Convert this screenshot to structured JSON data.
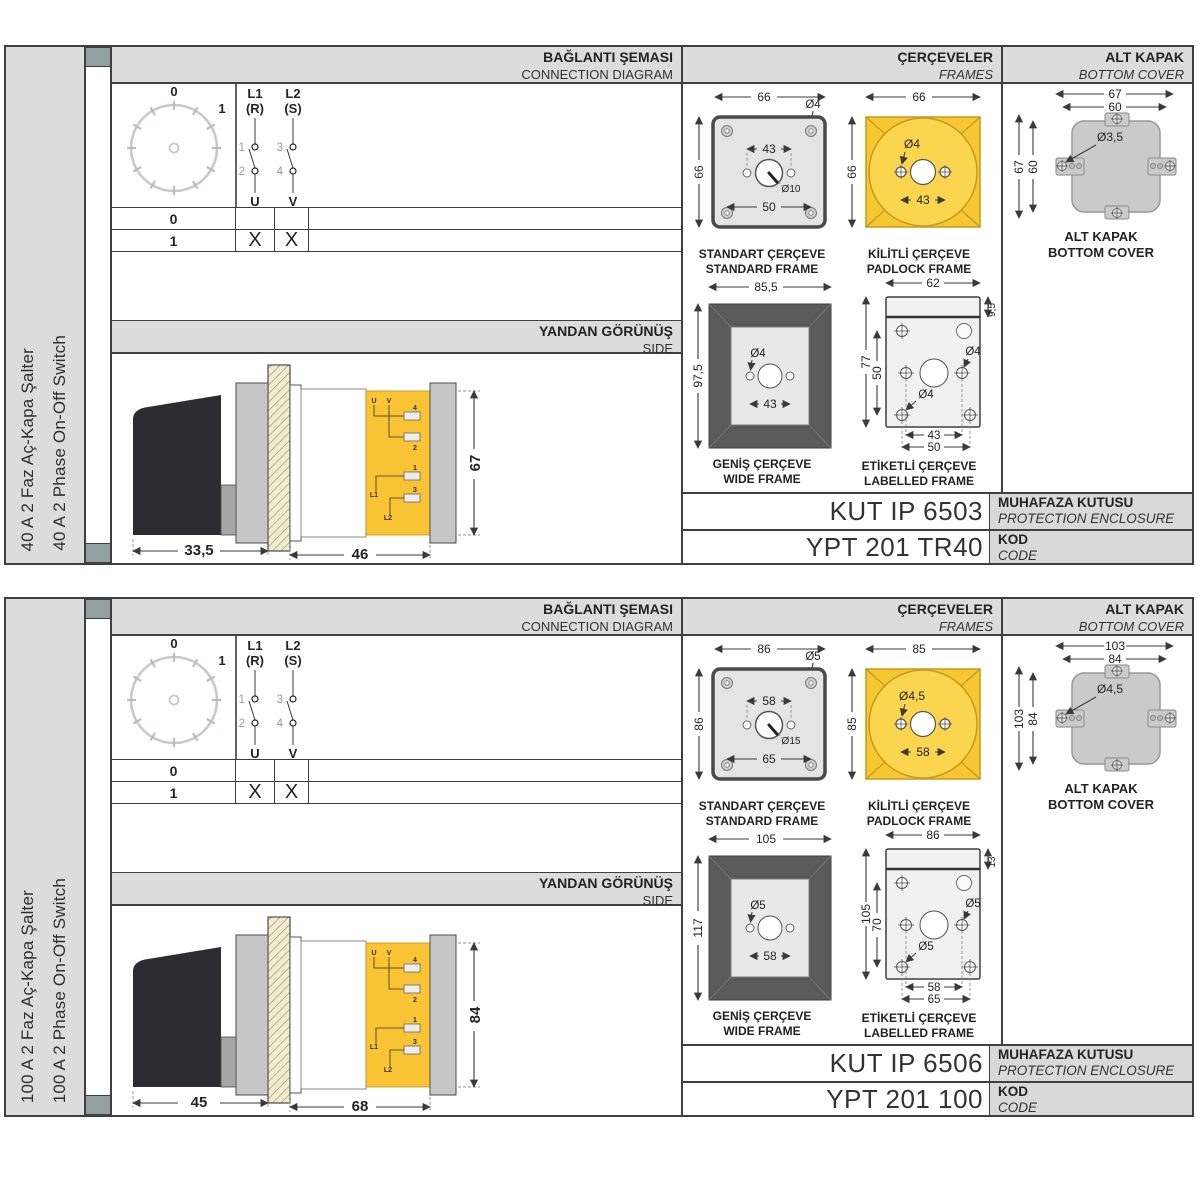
{
  "panels": [
    {
      "side_label_tr": "40 A 2 Faz Aç-Kapa Şalter",
      "side_label_en": "40 A 2 Phase On-Off Switch",
      "headers": {
        "connection_tr": "BAĞLANTI ŞEMASI",
        "connection_en": "CONNECTION DIAGRAM",
        "frames_tr": "ÇERÇEVELER",
        "frames_en": "FRAMES",
        "cover_tr": "ALT KAPAK",
        "cover_en": "BOTTOM COVER",
        "side_tr": "YANDAN GÖRÜNÜŞ",
        "side_en": "SIDE"
      },
      "connection": {
        "dial": {
          "pos0": "0",
          "pos1": "1"
        },
        "contacts": {
          "l1": "L1",
          "l1_phase": "(R)",
          "l2": "L2",
          "l2_phase": "(S)",
          "t1": "1",
          "t2": "2",
          "t3": "3",
          "t4": "4",
          "u": "U",
          "v": "V"
        },
        "table": {
          "rows": [
            {
              "pos": "0",
              "u": "",
              "v": ""
            },
            {
              "pos": "1",
              "u": "X",
              "v": "X"
            }
          ]
        }
      },
      "side_view": {
        "dim_front": "33,5",
        "dim_body": "46",
        "dim_height": "67",
        "terminals": {
          "u": "U",
          "v": "V",
          "n4": "4",
          "n2": "2",
          "n1": "1",
          "n3": "3",
          "l1": "L1",
          "l2": "L2"
        }
      },
      "frames": {
        "standard": {
          "caption_tr": "STANDART ÇERÇEVE",
          "caption_en": "STANDARD FRAME",
          "width": "66",
          "height": "66",
          "hole_dia": "Ø4",
          "top_span": "43",
          "bottom_span": "50",
          "center_dia": "Ø10"
        },
        "padlock": {
          "caption_tr": "KİLİTLİ ÇERÇEVE",
          "caption_en": "PADLOCK FRAME",
          "width": "66",
          "height": "66",
          "hole_dia": "Ø4",
          "span": "43"
        },
        "wide": {
          "caption_tr": "GENİŞ ÇERÇEVE",
          "caption_en": "WIDE FRAME",
          "width": "85,5",
          "height": "97,5",
          "hole_dia": "Ø4",
          "span": "43"
        },
        "labelled": {
          "caption_tr": "ETİKETLİ ÇERÇEVE",
          "caption_en": "LABELLED FRAME",
          "top_width": "62",
          "strip": "9,5",
          "height": "77",
          "inner_height": "50",
          "hole_dia": "Ø4",
          "hole_dia2": "Ø4",
          "span1": "43",
          "span2": "50"
        }
      },
      "bottom_cover": {
        "caption_tr": "ALT KAPAK",
        "caption_en": "BOTTOM COVER",
        "outer_w": "67",
        "inner_w": "60",
        "outer_h": "67",
        "inner_h": "60",
        "hole_dia": "Ø3,5"
      },
      "codes": {
        "enclosure_value": "KUT IP 6503",
        "enclosure_label_tr": "MUHAFAZA KUTUSU",
        "enclosure_label_en": "PROTECTION ENCLOSURE",
        "code_value": "YPT 201 TR40",
        "code_label_tr": "KOD",
        "code_label_en": "CODE"
      }
    },
    {
      "side_label_tr": "100 A 2 Faz Aç-Kapa Şalter",
      "side_label_en": "100 A 2 Phase On-Off Switch",
      "headers": {
        "connection_tr": "BAĞLANTI ŞEMASI",
        "connection_en": "CONNECTION DIAGRAM",
        "frames_tr": "ÇERÇEVELER",
        "frames_en": "FRAMES",
        "cover_tr": "ALT KAPAK",
        "cover_en": "BOTTOM COVER",
        "side_tr": "YANDAN GÖRÜNÜŞ",
        "side_en": "SIDE"
      },
      "connection": {
        "dial": {
          "pos0": "0",
          "pos1": "1"
        },
        "contacts": {
          "l1": "L1",
          "l1_phase": "(R)",
          "l2": "L2",
          "l2_phase": "(S)",
          "t1": "1",
          "t2": "2",
          "t3": "3",
          "t4": "4",
          "u": "U",
          "v": "V"
        },
        "table": {
          "rows": [
            {
              "pos": "0",
              "u": "",
              "v": ""
            },
            {
              "pos": "1",
              "u": "X",
              "v": "X"
            }
          ]
        }
      },
      "side_view": {
        "dim_front": "45",
        "dim_body": "68",
        "dim_height": "84",
        "terminals": {
          "u": "U",
          "v": "V",
          "n4": "4",
          "n2": "2",
          "n1": "1",
          "n3": "3",
          "l1": "L1",
          "l2": "L2"
        }
      },
      "frames": {
        "standard": {
          "caption_tr": "STANDART ÇERÇEVE",
          "caption_en": "STANDARD FRAME",
          "width": "86",
          "height": "86",
          "hole_dia": "Ø5",
          "top_span": "58",
          "bottom_span": "65",
          "center_dia": "Ø15"
        },
        "padlock": {
          "caption_tr": "KİLİTLİ ÇERÇEVE",
          "caption_en": "PADLOCK FRAME",
          "width": "85",
          "height": "85",
          "hole_dia": "Ø4,5",
          "span": "58"
        },
        "wide": {
          "caption_tr": "GENİŞ ÇERÇEVE",
          "caption_en": "WIDE FRAME",
          "width": "105",
          "height": "117",
          "hole_dia": "Ø5",
          "span": "58"
        },
        "labelled": {
          "caption_tr": "ETİKETLİ ÇERÇEVE",
          "caption_en": "LABELLED FRAME",
          "top_width": "86",
          "strip": "13",
          "height": "105",
          "inner_height": "70",
          "hole_dia": "Ø5",
          "hole_dia2": "Ø5",
          "span1": "58",
          "span2": "65"
        }
      },
      "bottom_cover": {
        "caption_tr": "ALT KAPAK",
        "caption_en": "BOTTOM COVER",
        "outer_w": "103",
        "inner_w": "84",
        "outer_h": "103",
        "inner_h": "84",
        "hole_dia": "Ø4,5"
      },
      "codes": {
        "enclosure_value": "KUT IP 6506",
        "enclosure_label_tr": "MUHAFAZA KUTUSU",
        "enclosure_label_en": "PROTECTION ENCLOSURE",
        "code_value": "YPT 201 100",
        "code_label_tr": "KOD",
        "code_label_en": "CODE"
      }
    }
  ]
}
